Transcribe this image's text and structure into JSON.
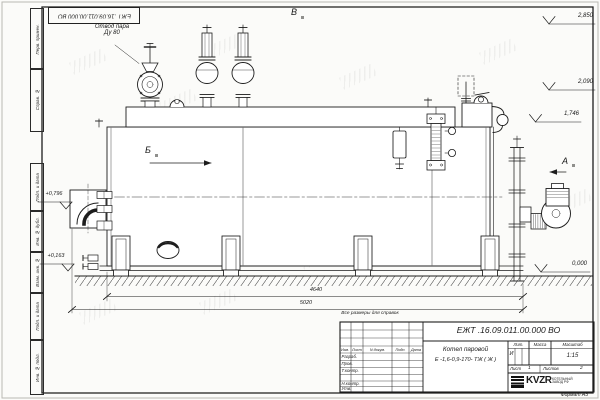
{
  "sheet": {
    "stamp_top": "ЕЖТ .16.09.011.00.000  ВО",
    "reference_note": "Все размеры для справок",
    "format_note": "Формат А3",
    "margin_labels": [
      "Перв. примен.",
      "Справ. №",
      "Подп. и дата",
      "Инв. № дубл.",
      "Взам. инв. №",
      "Подп. и дата",
      "Инв. № подл."
    ]
  },
  "drawing": {
    "callout_steam_line1": "Отвод пара",
    "callout_steam_line2": "Ду 80",
    "views": {
      "top": "В",
      "left": "Б",
      "right": "А"
    },
    "elevations": {
      "e2850": "2,850",
      "e2090": "2,090",
      "e1746": "1,746",
      "e0796": "+0,796",
      "e0163": "+0,163",
      "e0000": "0,000"
    },
    "dimensions": {
      "d4640": "4640",
      "d5020": "5020"
    }
  },
  "title_block": {
    "doc_number": "ЕЖТ .16.09.011.00.000   ВО",
    "title_line1": "Котел паровой",
    "title_line2": "Е -1,6-0,9-170- ТЖ ( Ж )",
    "headers": {
      "izm": "Изм.",
      "list": "Лист",
      "doc": "N докум.",
      "podp": "Подп.",
      "data": "Дата",
      "lit": "Лит.",
      "massa": "Масса",
      "masshtab": "Масштаб"
    },
    "rows": {
      "razrab": "Разраб.",
      "prov": "Пров.",
      "tkontr": "Т.контр.",
      "nkontr": "Н.контр.",
      "utv": "Утв."
    },
    "lit_value": "И",
    "scale": "1:15",
    "sheet_label": "Лист",
    "sheet_value": "1",
    "sheets_label": "Листов",
    "sheets_value": "2",
    "company": {
      "logo": "KVZR",
      "name_line1": "КОТЕЛЬНЫЙ",
      "name_line2": "ЗАВОД РФ"
    }
  }
}
